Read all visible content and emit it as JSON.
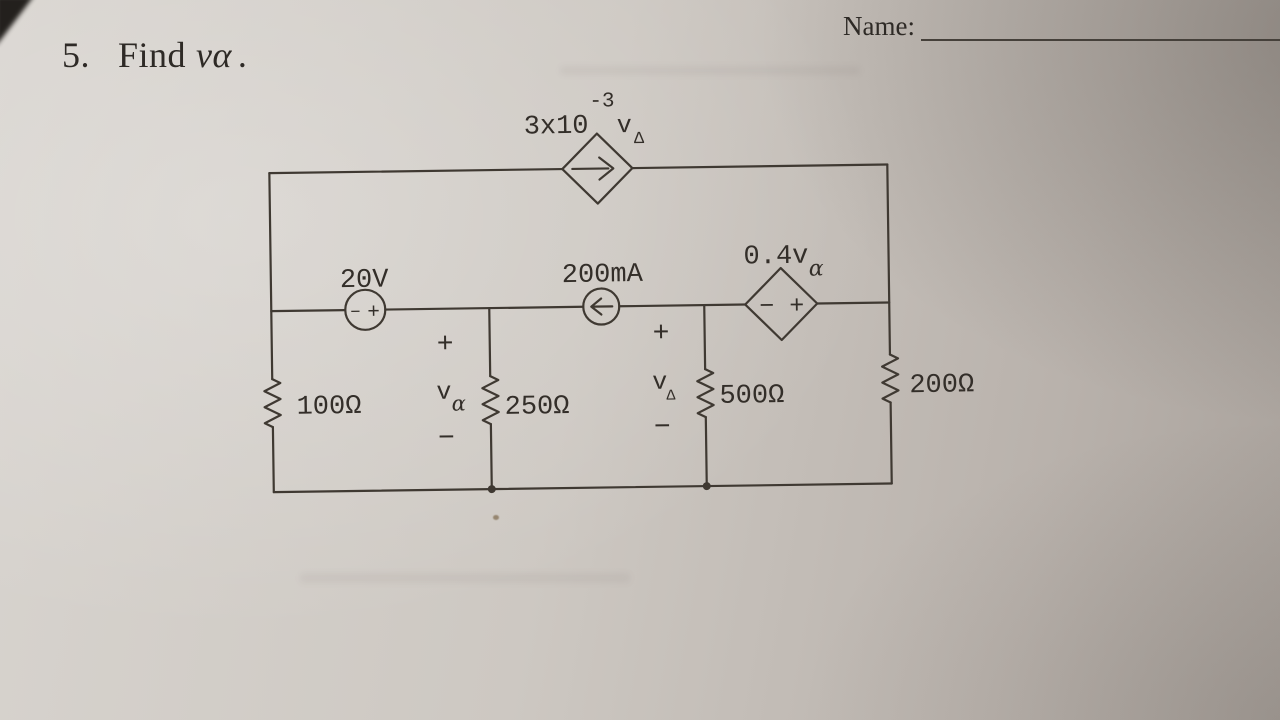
{
  "header": {
    "name_label": "Name:",
    "problem_number": "5.",
    "problem_text": "Find",
    "problem_var": "v",
    "problem_var_sub": "α",
    "problem_period": "."
  },
  "circuit": {
    "dependent_current_source": {
      "coefficient": "3x10",
      "exponent": "-3",
      "variable": "v",
      "variable_sub": "Δ"
    },
    "voltage_source": {
      "label": "20V",
      "minus_sign": "−",
      "plus_sign": "+"
    },
    "current_source": {
      "label": "200mA"
    },
    "dependent_voltage_source": {
      "label": "0.4v",
      "label_sub": "α",
      "polarity": "− +"
    },
    "resistor_100": "100Ω",
    "resistor_250": "250Ω",
    "resistor_500": "500Ω",
    "resistor_200": "200Ω",
    "v_alpha": {
      "plus": "+",
      "variable": "v",
      "sub": "α",
      "minus": "−"
    },
    "v_delta": {
      "plus": "+",
      "variable": "v",
      "sub": "Δ",
      "minus": "−"
    }
  }
}
